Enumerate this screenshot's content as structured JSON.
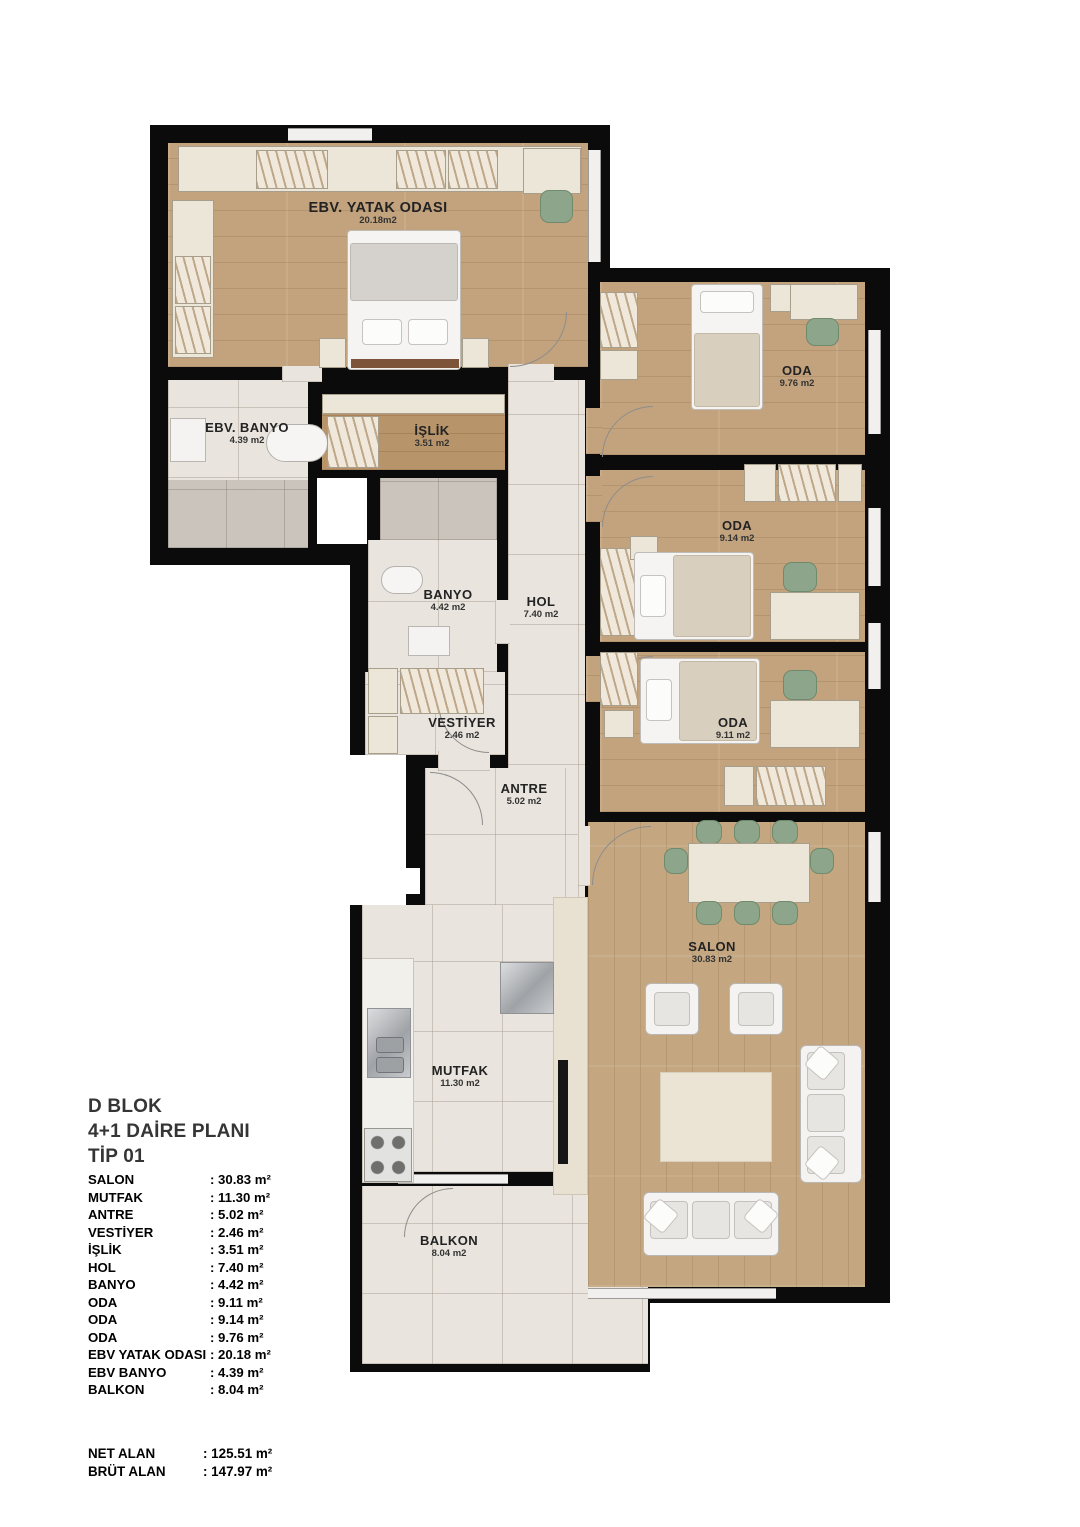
{
  "title": {
    "line1": "D BLOK",
    "line2": "4+1 DAİRE PLANI",
    "line3": "TİP 01"
  },
  "rooms": [
    {
      "name": "EBV. YATAK ODASI",
      "area": "20.18m2"
    },
    {
      "name": "EBV. BANYO",
      "area": "4.39 m2"
    },
    {
      "name": "İŞLİK",
      "area": "3.51 m2"
    },
    {
      "name": "BANYO",
      "area": "4.42 m2"
    },
    {
      "name": "HOL",
      "area": "7.40 m2"
    },
    {
      "name": "VESTİYER",
      "area": "2.46 m2"
    },
    {
      "name": "ANTRE",
      "area": "5.02 m2"
    },
    {
      "name": "MUTFAK",
      "area": "11.30 m2"
    },
    {
      "name": "BALKON",
      "area": "8.04 m2"
    },
    {
      "name": "ODA",
      "area": "9.76 m2"
    },
    {
      "name": "ODA",
      "area": "9.14 m2"
    },
    {
      "name": "ODA",
      "area": "9.11 m2"
    },
    {
      "name": "SALON",
      "area": "30.83 m2"
    }
  ],
  "legend": {
    "items": [
      {
        "name": "SALON",
        "value": ": 30.83 m²"
      },
      {
        "name": "MUTFAK",
        "value": ": 11.30 m²"
      },
      {
        "name": "ANTRE",
        "value": ": 5.02 m²"
      },
      {
        "name": "VESTİYER",
        "value": ": 2.46 m²"
      },
      {
        "name": "İŞLİK",
        "value": ": 3.51 m²"
      },
      {
        "name": "HOL",
        "value": ": 7.40 m²"
      },
      {
        "name": "BANYO",
        "value": ": 4.42 m²"
      },
      {
        "name": "ODA",
        "value": ": 9.11 m²"
      },
      {
        "name": "ODA",
        "value": ": 9.14 m²"
      },
      {
        "name": "ODA",
        "value": ": 9.76 m²"
      },
      {
        "name": "EBV YATAK ODASI",
        "value": ": 20.18 m²"
      },
      {
        "name": "EBV BANYO",
        "value": ": 4.39 m²"
      },
      {
        "name": "BALKON",
        "value": ": 8.04 m²"
      }
    ],
    "totals": [
      {
        "name": "NET ALAN",
        "value": ": 125.51 m²"
      },
      {
        "name": "BRÜT ALAN",
        "value": ": 147.97 m²"
      }
    ]
  },
  "colors": {
    "wall": "#0b0b0b",
    "wood_floor": "#c2a37d",
    "tile_floor": "#e9e4dd",
    "gray_tile": "#cac4bd",
    "furniture_cream": "#ece6d8",
    "accent_green": "#8da68b"
  }
}
